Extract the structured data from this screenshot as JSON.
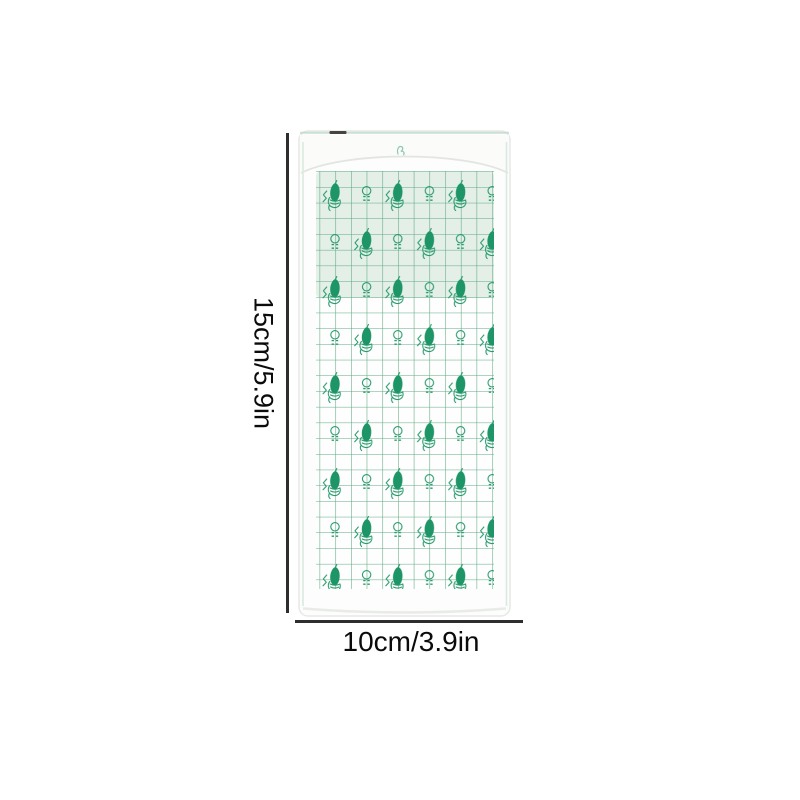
{
  "image": {
    "subject": "transparent waterproof film dressing package with green grid backing print"
  },
  "annotations": {
    "height_label": "15cm/5.9in",
    "width_label": "10cm/3.9in"
  },
  "icons": {
    "hand_leaf_motif": "hand-holding-leaf-motif",
    "circle_dash_motif": "circle-with-dashes-motif",
    "squiggle": "green-squiggle-mark"
  },
  "colors": {
    "page_bg": "#ffffff",
    "motif_green": "#1e9566",
    "grid_green": "#55a47c",
    "mint_tint": "#e3efe7",
    "package_white": "#fcfdfc",
    "package_edge": "#e6e9e5",
    "edge_teal": "#bdd9c9",
    "dimension_line": "#2e2e2e",
    "label_text": "#0b0b0b"
  }
}
